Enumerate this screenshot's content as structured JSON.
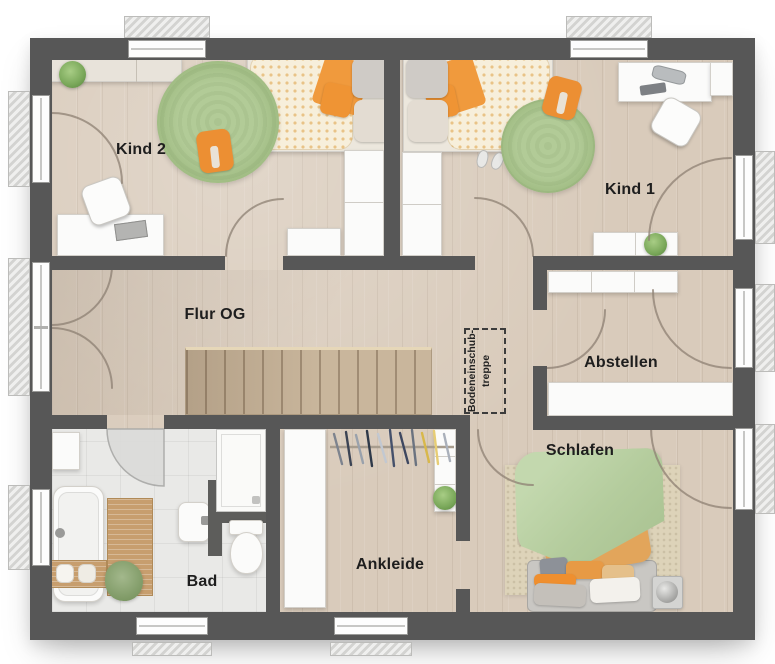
{
  "plan": {
    "type": "floor-plan",
    "floor_name": "Obergeschoss"
  },
  "rooms": {
    "kind2": {
      "label": "Kind 2"
    },
    "kind1": {
      "label": "Kind 1"
    },
    "flur_og": {
      "label": "Flur OG"
    },
    "abstellen": {
      "label": "Abstellen"
    },
    "schlafen": {
      "label": "Schlafen"
    },
    "ankleide": {
      "label": "Ankleide"
    },
    "bad": {
      "label": "Bad"
    }
  },
  "annotation": {
    "loft_hatch_line1": "Bodeneinschub-",
    "loft_hatch_line2": "treppe"
  },
  "colors": {
    "wall": "#575757",
    "wood_floor": "#d9cbbb",
    "bath_floor": "#e9e9e7",
    "stairs": "#c9b69c",
    "accent_orange": "#ef9838",
    "rug_green": "#a9c48e",
    "bed_green": "#bad0a4",
    "furniture_white": "#fbfbfa"
  }
}
